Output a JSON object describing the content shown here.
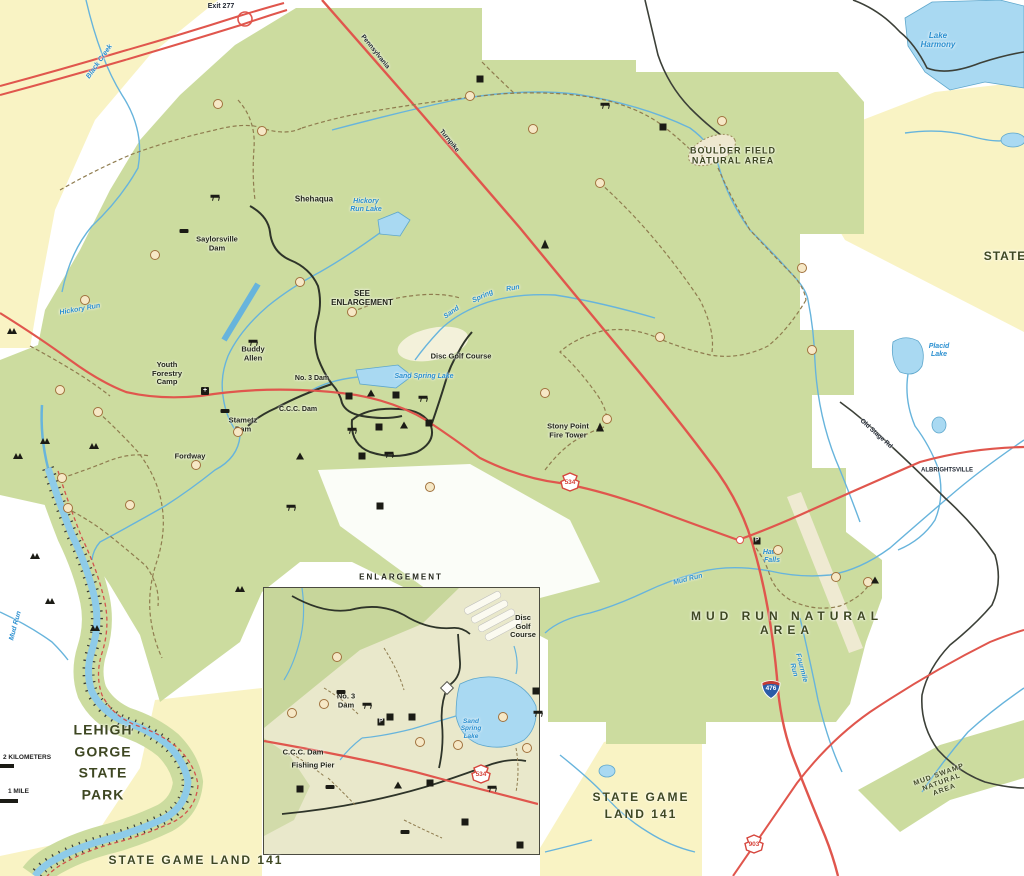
{
  "colors": {
    "park_green": "#ccdc9f",
    "inset_green": "#c7d69b",
    "public_land_yellow": "#f9f3c4",
    "water_fill": "#a9d9f2",
    "stream_blue": "#67b4dc",
    "river_blue": "#8ecbe8",
    "road_red": "#e0564d",
    "road_black": "#3c4038",
    "trail_dash": "#8f7c4f",
    "label_area": "#3e4722",
    "label_water": "#2a8fd0",
    "keystone_red": "#d6453c",
    "interstate_blue": "#2b5ca8"
  },
  "map": {
    "labels": [
      {
        "n": "label-boulder-field",
        "t": "BOULDER FIELD\nNATURAL AREA",
        "x": 733,
        "y": 156,
        "fs": 9,
        "cls": "area"
      },
      {
        "n": "label-mud-run-na",
        "t": "MUD RUN NATURAL AREA",
        "x": 787,
        "y": 624,
        "fs": 12,
        "cls": "area",
        "ls": 5
      },
      {
        "n": "label-mud-swamp-na",
        "t": "MUD SWAMP NATURAL\nAREA",
        "x": 942,
        "y": 783,
        "fs": 7,
        "cls": "area",
        "rot": -20
      },
      {
        "n": "label-lehigh-gorge",
        "t": "LEHIGH\nGORGE\nSTATE\nPARK",
        "x": 103,
        "y": 763,
        "fs": 14,
        "cls": "area",
        "lh": 1.55
      },
      {
        "n": "label-sgl141-bottom",
        "t": "STATE GAME LAND 141",
        "x": 196,
        "y": 861,
        "fs": 12,
        "cls": "area",
        "ls": 2
      },
      {
        "n": "label-sgl141-right",
        "t": "STATE GAME\nLAND 141",
        "x": 641,
        "y": 806,
        "fs": 12,
        "cls": "area",
        "ls": 2,
        "lh": 1.4
      },
      {
        "n": "label-state-edge",
        "t": "STATE",
        "x": 1005,
        "y": 257,
        "fs": 12,
        "cls": "area"
      },
      {
        "n": "label-see-enlargement",
        "t": "SEE\nENLARGEMENT",
        "x": 362,
        "y": 298,
        "fs": 8,
        "cls": "place"
      },
      {
        "n": "label-shehaqua",
        "t": "Shehaqua",
        "x": 314,
        "y": 199,
        "fs": 8,
        "cls": "place"
      },
      {
        "n": "label-saylorsville-dam",
        "t": "Saylorsville\nDam",
        "x": 217,
        "y": 244,
        "fs": 7.5,
        "cls": "place"
      },
      {
        "n": "label-buddy-allen",
        "t": "Buddy\nAllen",
        "x": 253,
        "y": 354,
        "fs": 7.5,
        "cls": "place"
      },
      {
        "n": "label-fordway",
        "t": "Fordway",
        "x": 190,
        "y": 457,
        "fs": 7.5,
        "cls": "place"
      },
      {
        "n": "label-youth-forestry-camp",
        "t": "Youth\nForestry\nCamp",
        "x": 167,
        "y": 374,
        "fs": 7.5,
        "cls": "place"
      },
      {
        "n": "label-no3-dam",
        "t": "No. 3 Dam",
        "x": 312,
        "y": 379,
        "fs": 7,
        "cls": "place"
      },
      {
        "n": "label-ccc-dam",
        "t": "C.C.C. Dam",
        "x": 298,
        "y": 410,
        "fs": 7,
        "cls": "place"
      },
      {
        "n": "label-stametz-dam",
        "t": "Stametz\nDam",
        "x": 243,
        "y": 425,
        "fs": 7.5,
        "cls": "place"
      },
      {
        "n": "label-disc-golf",
        "t": "Disc Golf Course",
        "x": 461,
        "y": 357,
        "fs": 7.5,
        "cls": "place"
      },
      {
        "n": "label-stony-point",
        "t": "Stony Point\nFire Tower",
        "x": 568,
        "y": 431,
        "fs": 7.5,
        "cls": "place"
      },
      {
        "n": "label-lake-harmony",
        "t": "Lake\nHarmony",
        "x": 938,
        "y": 40,
        "fs": 8,
        "cls": "water"
      },
      {
        "n": "label-black-creek",
        "t": "Black Creek",
        "x": 100,
        "y": 62,
        "fs": 7,
        "cls": "water",
        "rot": -55
      },
      {
        "n": "label-hickory-run-lake",
        "t": "Hickory\nRun Lake",
        "x": 366,
        "y": 206,
        "fs": 7,
        "cls": "water"
      },
      {
        "n": "label-hickory-run",
        "t": "Hickory Run",
        "x": 80,
        "y": 310,
        "fs": 7,
        "cls": "water",
        "rot": -10
      },
      {
        "n": "label-sand",
        "t": "Sand",
        "x": 452,
        "y": 313,
        "fs": 7,
        "cls": "water",
        "rot": -35
      },
      {
        "n": "label-spring",
        "t": "Spring",
        "x": 483,
        "y": 297,
        "fs": 7,
        "cls": "water",
        "rot": -25
      },
      {
        "n": "label-run",
        "t": "Run",
        "x": 513,
        "y": 289,
        "fs": 7,
        "cls": "water",
        "rot": -10
      },
      {
        "n": "label-sand-spring-lake",
        "t": "Sand Spring Lake",
        "x": 424,
        "y": 377,
        "fs": 7,
        "cls": "water"
      },
      {
        "n": "label-mud-run",
        "t": "Mud Run",
        "x": 688,
        "y": 580,
        "fs": 7,
        "cls": "water",
        "rot": -14
      },
      {
        "n": "label-mud-run-west",
        "t": "Mud Run",
        "x": 16,
        "y": 626,
        "fs": 7,
        "cls": "water",
        "rot": -75
      },
      {
        "n": "label-hawk-falls",
        "t": "Hawk\nFalls",
        "x": 772,
        "y": 557,
        "fs": 7,
        "cls": "water"
      },
      {
        "n": "label-placid-lake",
        "t": "Placid\nLake",
        "x": 939,
        "y": 351,
        "fs": 7,
        "cls": "water"
      },
      {
        "n": "label-fourmile-run",
        "t": "Fourmile\nRun",
        "x": 797,
        "y": 669,
        "fs": 7,
        "cls": "water",
        "rot": 75
      },
      {
        "n": "label-exit-277",
        "t": "Exit 277",
        "x": 221,
        "y": 7,
        "fs": 7,
        "cls": "road"
      },
      {
        "n": "label-albrightsville",
        "t": "ALBRIGHTSVILLE",
        "x": 947,
        "y": 471,
        "fs": 6,
        "cls": "road"
      },
      {
        "n": "label-old-stage-rd",
        "t": "Old Stage Rd",
        "x": 876,
        "y": 434,
        "fs": 6.5,
        "cls": "road",
        "rot": 42
      },
      {
        "n": "label-turnpike-1",
        "t": "Pennsylvania",
        "x": 375,
        "y": 52,
        "fs": 6.5,
        "cls": "road",
        "rot": 51
      },
      {
        "n": "label-turnpike-2",
        "t": "Turnpike",
        "x": 449,
        "y": 141,
        "fs": 6.5,
        "cls": "road",
        "rot": 51
      },
      {
        "n": "inset-title",
        "t": "ENLARGEMENT",
        "x": 401,
        "y": 577,
        "fs": 8,
        "cls": "place",
        "ls": 2
      },
      {
        "n": "inset-disc-golf",
        "t": "Disc\nGolf\nCourse",
        "x": 523,
        "y": 627,
        "fs": 7.5,
        "cls": "place"
      },
      {
        "n": "inset-no3-dam",
        "t": "No. 3\nDam",
        "x": 346,
        "y": 701,
        "fs": 7.5,
        "cls": "place"
      },
      {
        "n": "inset-ccc-dam",
        "t": "C.C.C. Dam",
        "x": 303,
        "y": 753,
        "fs": 7.5,
        "cls": "place"
      },
      {
        "n": "inset-fishing-pier",
        "t": "Fishing Pier",
        "x": 313,
        "y": 766,
        "fs": 7.5,
        "cls": "place"
      },
      {
        "n": "inset-sand-spring-lake",
        "t": "Sand\nSpring\nLake",
        "x": 471,
        "y": 729,
        "fs": 6.5,
        "cls": "water"
      }
    ],
    "shields": [
      {
        "k": "keystone",
        "t": "534",
        "x": 570,
        "y": 482
      },
      {
        "k": "keystone",
        "t": "534",
        "x": 481,
        "y": 774
      },
      {
        "k": "keystone",
        "t": "903",
        "x": 754,
        "y": 844
      },
      {
        "k": "interstate",
        "t": "476",
        "x": 771,
        "y": 687
      }
    ],
    "scale_bar": {
      "km": "2 KILOMETERS",
      "mile": "1 MILE"
    },
    "trail_markers": [
      [
        218,
        104
      ],
      [
        262,
        131
      ],
      [
        470,
        96
      ],
      [
        533,
        129
      ],
      [
        600,
        183
      ],
      [
        722,
        121
      ],
      [
        802,
        268
      ],
      [
        812,
        350
      ],
      [
        660,
        337
      ],
      [
        545,
        393
      ],
      [
        607,
        419
      ],
      [
        155,
        255
      ],
      [
        85,
        300
      ],
      [
        60,
        390
      ],
      [
        98,
        412
      ],
      [
        62,
        478
      ],
      [
        68,
        508
      ],
      [
        130,
        505
      ],
      [
        196,
        465
      ],
      [
        300,
        282
      ],
      [
        352,
        312
      ],
      [
        430,
        487
      ],
      [
        238,
        432
      ],
      [
        778,
        550
      ],
      [
        836,
        577
      ],
      [
        868,
        582
      ],
      [
        337,
        657
      ],
      [
        292,
        713
      ],
      [
        324,
        704
      ],
      [
        420,
        742
      ],
      [
        458,
        745
      ],
      [
        503,
        717
      ],
      [
        527,
        748
      ]
    ],
    "facilities": [
      [
        215,
        196,
        "picnic"
      ],
      [
        184,
        231,
        "dam"
      ],
      [
        253,
        341,
        "picnic"
      ],
      [
        225,
        411,
        "dam"
      ],
      [
        205,
        391,
        "cross"
      ],
      [
        545,
        244,
        "tower"
      ],
      [
        480,
        79,
        "sq"
      ],
      [
        605,
        104,
        "picnic"
      ],
      [
        663,
        127,
        "sq"
      ],
      [
        349,
        396,
        "sq"
      ],
      [
        371,
        393,
        "tent"
      ],
      [
        396,
        395,
        "sq"
      ],
      [
        423,
        397,
        "picnic"
      ],
      [
        352,
        429,
        "picnic"
      ],
      [
        379,
        427,
        "sq"
      ],
      [
        404,
        425,
        "tent"
      ],
      [
        429,
        423,
        "sq"
      ],
      [
        362,
        456,
        "sq"
      ],
      [
        389,
        453,
        "picnic"
      ],
      [
        300,
        456,
        "tent"
      ],
      [
        291,
        506,
        "picnic"
      ],
      [
        380,
        506,
        "sq"
      ],
      [
        12,
        331,
        "vista"
      ],
      [
        45,
        441,
        "vista"
      ],
      [
        18,
        456,
        "vista"
      ],
      [
        94,
        446,
        "vista"
      ],
      [
        35,
        556,
        "vista"
      ],
      [
        50,
        601,
        "vista"
      ],
      [
        95,
        628,
        "vista"
      ],
      [
        240,
        589,
        "vista"
      ],
      [
        600,
        427,
        "tower"
      ],
      [
        757,
        541,
        "p"
      ],
      [
        875,
        580,
        "tent"
      ],
      [
        390,
        717,
        "sq"
      ],
      [
        412,
        717,
        "sq"
      ],
      [
        367,
        704,
        "picnic"
      ],
      [
        341,
        692,
        "dam"
      ],
      [
        300,
        789,
        "sq"
      ],
      [
        330,
        787,
        "dam"
      ],
      [
        398,
        785,
        "tent"
      ],
      [
        430,
        783,
        "sq"
      ],
      [
        405,
        832,
        "dam"
      ],
      [
        465,
        822,
        "sq"
      ],
      [
        520,
        845,
        "sq"
      ],
      [
        492,
        787,
        "picnic"
      ],
      [
        538,
        712,
        "picnic"
      ],
      [
        536,
        691,
        "sq"
      ],
      [
        447,
        688,
        "diamond"
      ],
      [
        381,
        722,
        "p"
      ]
    ]
  }
}
